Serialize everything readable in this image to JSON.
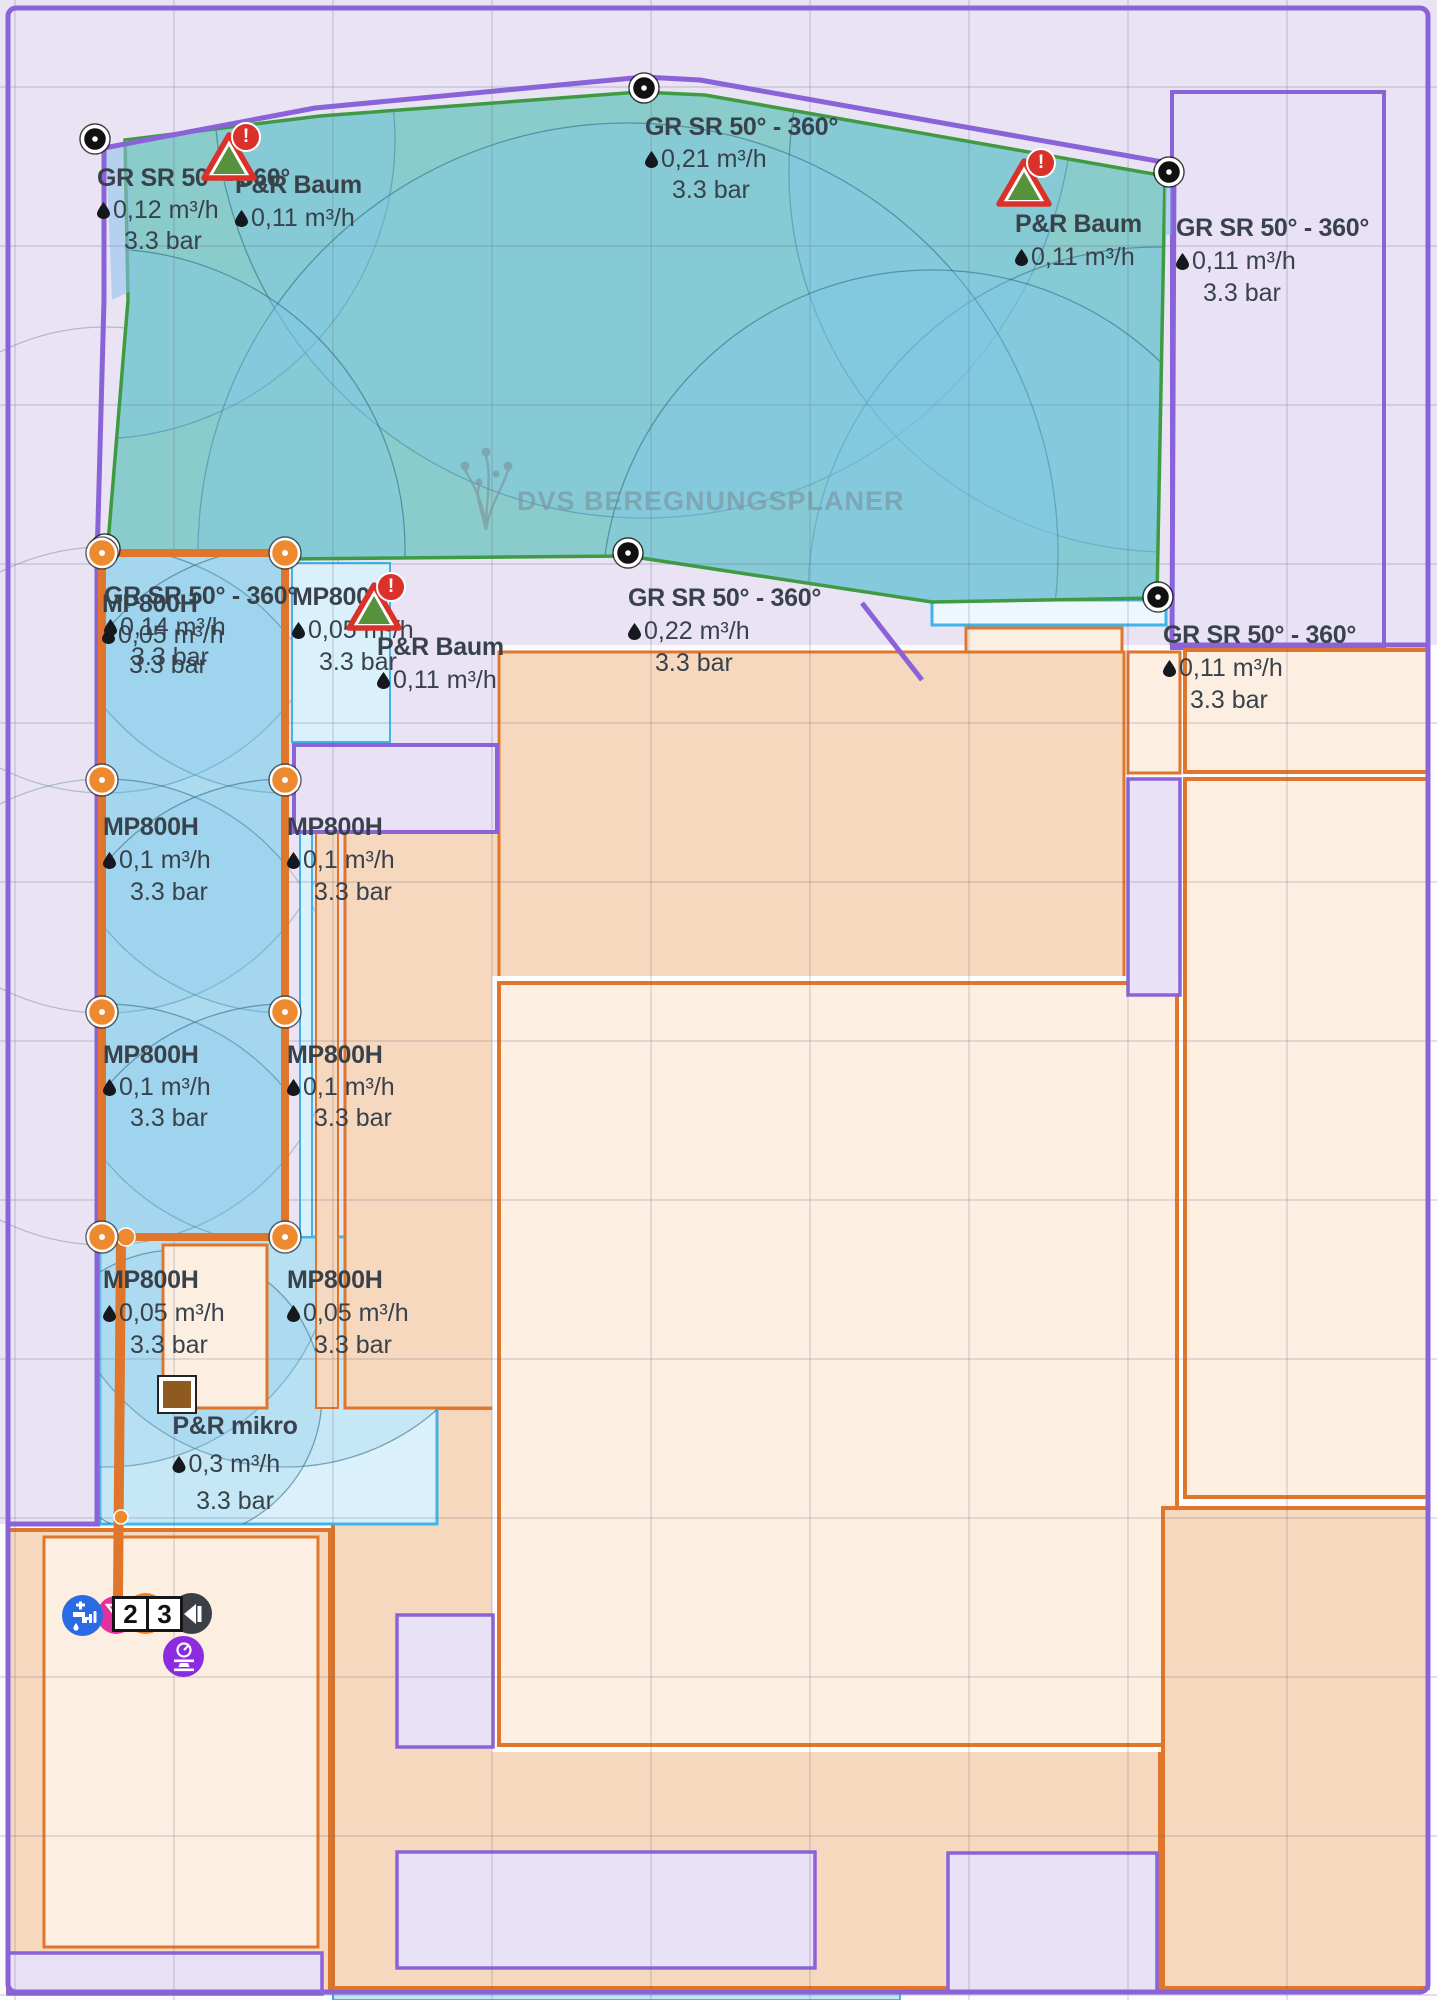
{
  "app": {
    "watermark": "DVS BEREGNUNGSPLANER"
  },
  "units": {
    "flow": "m³/h",
    "pressure": "bar"
  },
  "labels": [
    {
      "id": "grsr-top-left",
      "name": "GR SR 50° - 360°",
      "flow": "0,12 m³/h",
      "pressure": "3.3 bar",
      "x": 97,
      "y": 166,
      "lh": 31,
      "align": "left"
    },
    {
      "id": "baum-top-left",
      "name": "P&R Baum",
      "flow": "0,11 m³/h",
      "pressure": null,
      "x": 235,
      "y": 173,
      "lh": 32,
      "align": "left"
    },
    {
      "id": "grsr-top-center",
      "name": "GR SR 50° - 360°",
      "flow": "0,21 m³/h",
      "pressure": "3.3 bar",
      "x": 645,
      "y": 115,
      "lh": 31,
      "align": "left"
    },
    {
      "id": "baum-top-right",
      "name": "P&R Baum",
      "flow": "0,11 m³/h",
      "pressure": null,
      "x": 1015,
      "y": 212,
      "lh": 32,
      "align": "left"
    },
    {
      "id": "grsr-top-right",
      "name": "GR SR 50° - 360°",
      "flow": "0,11 m³/h",
      "pressure": "3.3 bar",
      "x": 1176,
      "y": 216,
      "lh": 32,
      "align": "left"
    },
    {
      "id": "grsr-center",
      "name": "GR SR 50° - 360°",
      "flow": "0,22 m³/h",
      "pressure": "3.3 bar",
      "x": 628,
      "y": 586,
      "lh": 32,
      "align": "left"
    },
    {
      "id": "grsr-strip-top",
      "name": "GR SR 50° - 360°",
      "flow": "0,14 m³/h",
      "pressure": "3.3 bar",
      "x": 104,
      "y": 584,
      "lh": 30,
      "align": "left"
    },
    {
      "id": "mp-strip-top",
      "name": "MP800H",
      "flow": "0,05 m³/h",
      "pressure": "3.3 bar",
      "x": 102,
      "y": 592,
      "lh": 30,
      "align": "left"
    },
    {
      "id": "mp-row1-right",
      "name": "MP800H",
      "flow": "0,05 m³/h",
      "pressure": "3.3 bar",
      "x": 292,
      "y": 585,
      "lh": 32,
      "align": "left"
    },
    {
      "id": "baum-center",
      "name": "P&R Baum",
      "flow": "0,11 m³/h",
      "pressure": null,
      "x": 377,
      "y": 635,
      "lh": 32,
      "align": "left"
    },
    {
      "id": "grsr-right-edge",
      "name": "GR SR 50° - 360°",
      "flow": "0,11 m³/h",
      "pressure": "3.3 bar",
      "x": 1163,
      "y": 623,
      "lh": 32,
      "align": "left"
    },
    {
      "id": "mp-row2-left",
      "name": "MP800H",
      "flow": "0,1 m³/h",
      "pressure": "3.3 bar",
      "x": 103,
      "y": 815,
      "lh": 32,
      "align": "left"
    },
    {
      "id": "mp-row2-right",
      "name": "MP800H",
      "flow": "0,1 m³/h",
      "pressure": "3.3 bar",
      "x": 287,
      "y": 815,
      "lh": 32,
      "align": "left"
    },
    {
      "id": "mp-row3-left",
      "name": "MP800H",
      "flow": "0,1 m³/h",
      "pressure": "3.3 bar",
      "x": 103,
      "y": 1043,
      "lh": 31,
      "align": "left"
    },
    {
      "id": "mp-row3-right",
      "name": "MP800H",
      "flow": "0,1 m³/h",
      "pressure": "3.3 bar",
      "x": 287,
      "y": 1043,
      "lh": 31,
      "align": "left"
    },
    {
      "id": "mp-row4-left",
      "name": "MP800H",
      "flow": "0,05 m³/h",
      "pressure": "3.3 bar",
      "x": 103,
      "y": 1268,
      "lh": 32,
      "align": "left"
    },
    {
      "id": "mp-row4-right",
      "name": "MP800H",
      "flow": "0,05 m³/h",
      "pressure": "3.3 bar",
      "x": 287,
      "y": 1268,
      "lh": 32,
      "align": "left"
    },
    {
      "id": "pr-mikro",
      "name": "P&R mikro",
      "flow": "0,3 m³/h",
      "pressure": "3.3 bar",
      "x": 235,
      "y": 1414,
      "lh": 37,
      "align": "center"
    }
  ],
  "warnings": [
    {
      "id": "warn-top-left",
      "x": 201,
      "y": 122,
      "badge": "!"
    },
    {
      "id": "warn-top-right",
      "x": 996,
      "y": 148,
      "badge": "!"
    },
    {
      "id": "warn-strip-top",
      "x": 346,
      "y": 572,
      "badge": "!"
    }
  ],
  "map": {
    "nodes": [
      [
        95,
        139
      ],
      [
        644,
        88
      ],
      [
        1169,
        172
      ],
      [
        1158,
        597
      ],
      [
        628,
        553
      ],
      [
        105,
        549
      ]
    ],
    "handles": [
      [
        102,
        553
      ],
      [
        285,
        553
      ],
      [
        102,
        780
      ],
      [
        285,
        780
      ],
      [
        102,
        1012
      ],
      [
        285,
        1012
      ],
      [
        102,
        1237
      ],
      [
        285,
        1237
      ]
    ],
    "junctions": [
      {
        "x": 126,
        "y": 1237,
        "r": 9
      },
      {
        "x": 121,
        "y": 1517,
        "r": 7
      }
    ],
    "green_circles": [
      [
        95,
        139,
        300
      ],
      [
        644,
        88,
        430
      ],
      [
        1169,
        172,
        380
      ],
      [
        1158,
        597,
        350
      ],
      [
        628,
        553,
        430
      ],
      [
        105,
        549,
        300
      ],
      [
        932,
        600,
        330
      ]
    ],
    "strip_arcs": [
      [
        105,
        560,
        233
      ],
      [
        285,
        560,
        233
      ],
      [
        105,
        780,
        233
      ],
      [
        285,
        780,
        233
      ],
      [
        105,
        1012,
        233
      ],
      [
        285,
        1012,
        233
      ],
      [
        105,
        1237,
        233
      ],
      [
        285,
        1237,
        233
      ]
    ],
    "blue_arcs": [
      [
        105,
        1237,
        230
      ],
      [
        285,
        1237,
        230
      ],
      [
        177,
        1395,
        145
      ]
    ],
    "grid": {
      "vertical": [
        15,
        174,
        333,
        492,
        651,
        810,
        969,
        1128,
        1287
      ],
      "horizontal": [
        87,
        246,
        405,
        564,
        723,
        882,
        1041,
        1200,
        1359,
        1518,
        1677,
        1836,
        1995
      ]
    }
  },
  "supply": {
    "zone_numbers": [
      "2",
      "3"
    ],
    "icons": [
      "water-tap-icon",
      "fertilizer-icon",
      "pump-icon",
      "valve-icon",
      "pressure-regulator-icon"
    ]
  },
  "colors": {
    "background": "#e9e3f4",
    "boundary_purple": "#8b63d9",
    "zone_orange": "#e0762c",
    "peach_dark": "#f6d8bf",
    "peach_light": "#fcefe1",
    "cyan_border": "#42b3e5",
    "strip_fill": "#c6e7f2",
    "green_border": "#3f9b41",
    "pipe": "#e0762c",
    "text": "#39424b",
    "warning_red": "#da322a",
    "warning_green": "#56913c",
    "tap_blue": "#2a6be4",
    "fert_pink": "#e3309e",
    "pump_orange": "#f08127",
    "valve_dark": "#3d3f47",
    "regulator_purple": "#8c2be0",
    "emitter_brown": "#8f5a1f"
  }
}
